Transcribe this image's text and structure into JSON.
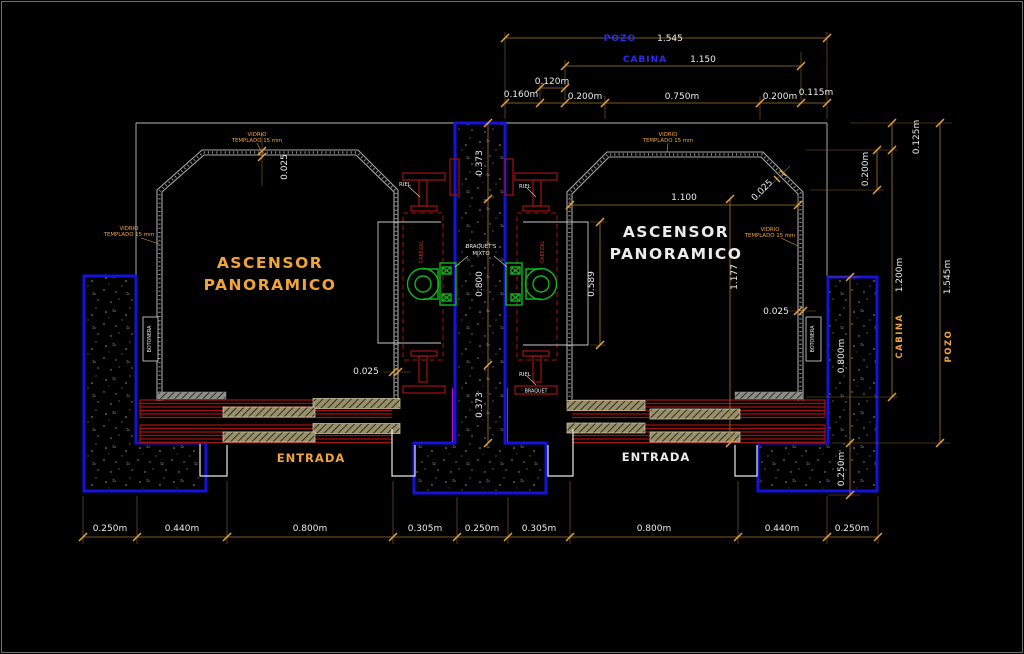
{
  "title": "Panoramic elevator CAD plan drawing",
  "colors": {
    "background": "#000000",
    "wall_blue": "#1313dc",
    "dimension_orange": "#a8762f",
    "text_blue": "#2a2af5",
    "text_orange": "#f0a43c",
    "text_white": "#ececec",
    "rail_red": "#a31212",
    "piston_green": "#12b41f"
  },
  "top": {
    "pozo": "POZO",
    "pozo_val": "1.545",
    "cabina": "CABINA",
    "cabina_val": "1.150",
    "d120": "0.120m",
    "d160": "0.160m",
    "d200l": "0.200m",
    "d750": "0.750m",
    "d200r": "0.200m",
    "d115": "0.115m"
  },
  "right": {
    "d125": "0.125m",
    "d200": "0.200m",
    "cabina": "CABINA",
    "cabina_val": "1.200m",
    "pozo": "POZO",
    "pozo_val": "1.545m",
    "d800": "0.800m",
    "d250": "0.250m"
  },
  "bottom": [
    "0.250m",
    "0.440m",
    "0.800m",
    "0.305m",
    "0.250m",
    "0.305m",
    "0.800m",
    "0.440m",
    "0.250m"
  ],
  "left_cabin": {
    "line1": "ASCENSOR",
    "line2": "PANORAMICO",
    "entrada": "ENTRADA",
    "botonera": "BOTONERA",
    "vidrio1a": "VIDRIO",
    "vidrio1b": "TEMPLADO 15 mm",
    "vidrio2a": "VIDRIO",
    "vidrio2b": "TEMPLADO 15 mm",
    "d025_top": "0.025",
    "d025_bot": "0.025"
  },
  "right_cabin": {
    "line1": "ASCENSOR",
    "line2": "PANORAMICO",
    "entrada": "ENTRADA",
    "botonera": "BOTONERA",
    "vidrio1a": "VIDRIO",
    "vidrio1b": "TEMPLADO 15 mm",
    "vidrio2a": "VIDRIO",
    "vidrio2b": "TEMPLADO 15 mm",
    "d1100": "1.100",
    "d1177": "1.177",
    "d589": "0.589",
    "d025_diag": "0.025",
    "d025_right": "0.025"
  },
  "center": {
    "d373_top": "0.373",
    "d800": "0.800",
    "d373_bot": "0.373",
    "riel_tl": "RIEL",
    "riel_tr": "RIEL",
    "riel_br": "RIEL",
    "cabezal_l": "CABEZAL",
    "cabezal_r": "CABEZAL",
    "braquets1": "BRAQUET'S",
    "braquets2": "MIXTO",
    "braquet": "BRAQUET"
  }
}
